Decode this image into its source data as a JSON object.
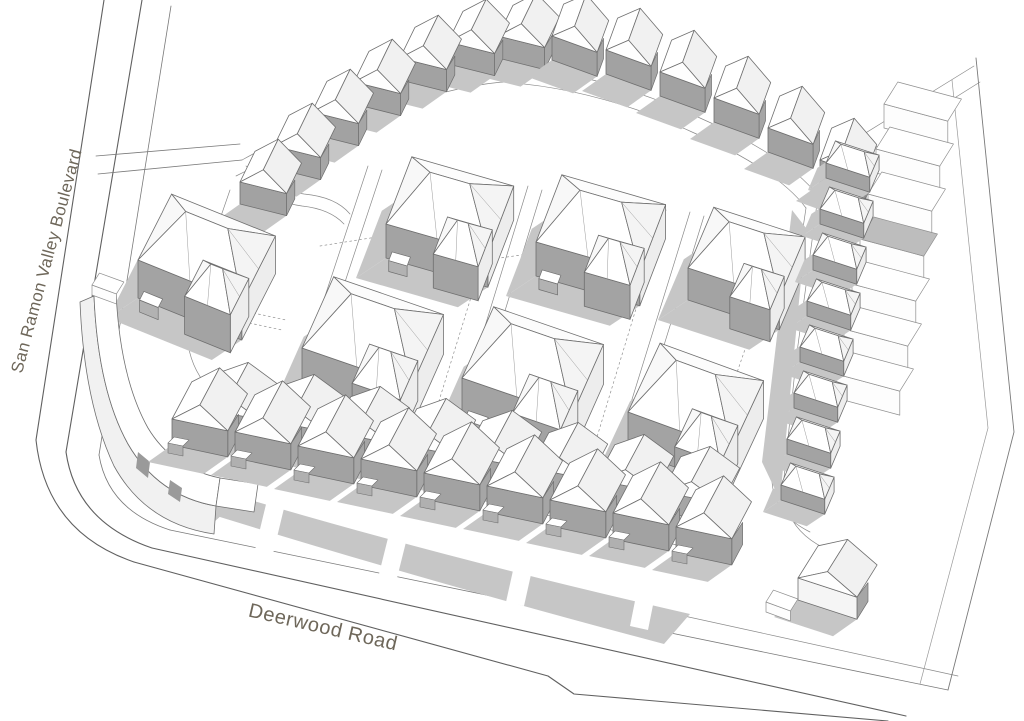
{
  "labels": {
    "boulevard": {
      "text": "San Ramon Valley Boulevard",
      "rotation_deg": -75
    },
    "road": {
      "text": "Deerwood Road",
      "rotation_deg": 13
    }
  },
  "diagram": {
    "kind": "3d-massing-site-plan-sketch",
    "ink": "#6f6f6f",
    "palette": {
      "background": "#ffffff",
      "wall_shade": "#a3a3a3",
      "wall_light": "#ededed",
      "roof_white": "#ffffff",
      "roof_tint": "#f2f2f2",
      "shadow": "#c6c6c6",
      "label_text": "#6e675a"
    },
    "ground": [
      {
        "d": "M 104,0 L 36,440",
        "s": "#606060",
        "w": 1.1
      },
      {
        "d": "M 142,0 L 66,452",
        "s": "#606060",
        "w": 1.1
      },
      {
        "d": "M 171,6 L 99,455",
        "s": "#7a7a7a",
        "w": 0.8
      },
      {
        "d": "M 36,440 Q 46,532 134,562",
        "s": "#606060",
        "w": 1.1
      },
      {
        "d": "M 66,452 Q 76,522 152,548",
        "s": "#606060",
        "w": 1.1
      },
      {
        "d": "M 99,455 Q 108,510 170,530",
        "s": "#7a7a7a",
        "w": 0.8
      },
      {
        "d": "M 134,562 L 548,676 L 574,694 L 888,721",
        "s": "#606060",
        "w": 1.1
      },
      {
        "d": "M 152,548 L 906,716",
        "s": "#606060",
        "w": 1.1
      },
      {
        "d": "M 170,530 L 948,690",
        "s": "#7a7a7a",
        "w": 0.8
      },
      {
        "d": "M 182,506 L 958,676",
        "s": "#8a8a8a",
        "w": 0.7
      },
      {
        "d": "M 948,690 L 1014,432 L 976,58",
        "s": "#7a7a7a",
        "w": 0.9
      },
      {
        "d": "M 920,684 L 988,428 L 952,80",
        "s": "#9a9a9a",
        "w": 0.7
      },
      {
        "d": "M 838,150 L 974,66",
        "s": "#8a8a8a",
        "w": 0.7
      },
      {
        "d": "M 846,166 L 980,82",
        "s": "#8a8a8a",
        "w": 0.7
      },
      {
        "d": "M 96,156 L 240,144",
        "s": "#7a7a7a",
        "w": 0.8
      },
      {
        "d": "M 98,174 L 242,160",
        "s": "#7a7a7a",
        "w": 0.8
      },
      {
        "d": "M 242,160 Q 300,128 360,104 Q 440,72 502,66 Q 600,72 700,118 Q 790,158 818,196",
        "s": "#8a8a8a",
        "w": 0.7
      },
      {
        "d": "M 236,176 Q 300,144 362,120 Q 440,88 502,82 Q 596,88 692,132 Q 778,170 806,208",
        "s": "#8a8a8a",
        "w": 0.7
      },
      {
        "d": "M 818,196 L 796,360 L 784,478 Q 780,526 824,548",
        "s": "#8a8a8a",
        "w": 0.7
      },
      {
        "d": "M 806,208 L 784,356 L 772,474 Q 770,512 810,532",
        "s": "#8a8a8a",
        "w": 0.7
      },
      {
        "d": "M 250,430 L 700,534",
        "s": "#8a8a8a",
        "w": 0.7
      },
      {
        "d": "M 246,446 L 690,548",
        "s": "#8a8a8a",
        "w": 0.7
      },
      {
        "d": "M 230,190 L 192,300 Q 176,356 214,394",
        "s": "#8a8a8a",
        "w": 0.7
      },
      {
        "d": "M 246,166 Q 274,190 304,194 Q 336,197 350,214",
        "s": "#8a8a8a",
        "w": 0.7
      },
      {
        "d": "M 242,178 Q 272,202 302,206 Q 330,209 344,224",
        "s": "#8a8a8a",
        "w": 0.7
      },
      {
        "d": "M 292,396 L 368,166",
        "s": "#8a8a8a",
        "w": 0.7
      },
      {
        "d": "M 306,400 L 382,170",
        "s": "#8a8a8a",
        "w": 0.7
      },
      {
        "d": "M 452,434 L 528,186",
        "s": "#8a8a8a",
        "w": 0.7
      },
      {
        "d": "M 466,438 L 542,190",
        "s": "#8a8a8a",
        "w": 0.7
      },
      {
        "d": "M 612,464 L 690,212",
        "s": "#8a8a8a",
        "w": 0.7
      },
      {
        "d": "M 626,468 L 704,216",
        "s": "#8a8a8a",
        "w": 0.7
      },
      {
        "d": "M 792,210 L 762,462 L 780,500 L 806,228 Z",
        "f": "#c6c6c6"
      },
      {
        "d": "M 836,252 L 918,240 L 912,266 L 830,278 Z",
        "f": "#c3c3c3"
      },
      {
        "d": "M 152,470 Q 400,548 690,614 L 664,644 Q 400,574 172,502 Z",
        "f": "#c6c6c6"
      },
      {
        "d": "M 268,496 L 286,500 L 272,558 L 254,554 Z",
        "f": "#ffffff"
      },
      {
        "d": "M 392,522 L 410,526 L 396,582 L 378,578 Z",
        "f": "#ffffff"
      },
      {
        "d": "M 518,548 L 536,552 L 524,606 L 506,602 Z",
        "f": "#ffffff"
      },
      {
        "d": "M 640,576 L 658,580 L 648,630 L 630,626 Z",
        "f": "#ffffff"
      },
      {
        "d": "M 142,300 L 282,330",
        "s": "#909090",
        "w": 0.7,
        "dash": "2 3"
      },
      {
        "d": "M 146,290 L 286,320",
        "s": "#909090",
        "w": 0.7,
        "dash": "2 3"
      },
      {
        "d": "M 430,430 L 506,184",
        "s": "#909090",
        "w": 0.7,
        "dash": "2 3"
      },
      {
        "d": "M 590,460 L 666,210",
        "s": "#909090",
        "w": 0.7,
        "dash": "2 3"
      },
      {
        "d": "M 700,480 L 762,300",
        "s": "#909090",
        "w": 0.7,
        "dash": "2 3"
      },
      {
        "d": "M 320,246 L 446,226",
        "s": "#909090",
        "w": 0.7,
        "dash": "2 3"
      },
      {
        "d": "M 472,262 L 598,244",
        "s": "#909090",
        "w": 0.7,
        "dash": "2 3"
      }
    ],
    "buildings": [
      {
        "group": "neighboring-buildings-east",
        "type": "slab",
        "dir_deg": 15,
        "w": 66,
        "d": 26,
        "h": 24,
        "p_list": [
          [
            884,
            128
          ],
          [
            876,
            173
          ],
          [
            868,
            218
          ],
          [
            860,
            263
          ],
          [
            852,
            308
          ],
          [
            844,
            353
          ],
          [
            836,
            398
          ]
        ],
        "roof_fills": [
          "#ffffff",
          "#ffffff",
          "#ffffff",
          "#bdbdbd",
          "#ffffff",
          "#ffffff",
          "#ffffff"
        ]
      },
      {
        "group": "townhouse-row-north-west",
        "type": "gable-row",
        "base_dir_deg": 14,
        "roof_dir_deg": -64,
        "unit_w": 48,
        "wall_h": 22,
        "roof_h": 18,
        "roof_depth": 34,
        "front_fill": "#a2a2a2",
        "porch": false,
        "anchors": [
          [
            498,
            58
          ],
          [
            448,
            64
          ],
          [
            400,
            80
          ],
          [
            354,
            104
          ],
          [
            312,
            134
          ],
          [
            274,
            168
          ],
          [
            240,
            204
          ]
        ]
      },
      {
        "group": "townhouse-row-north-east",
        "type": "gable-row",
        "base_dir_deg": 20,
        "roof_dir_deg": -70,
        "unit_w": 48,
        "wall_h": 24,
        "roof_h": 18,
        "roof_depth": 34,
        "front_fill": "#a2a2a2",
        "porch": false,
        "anchors": [
          [
            552,
            60
          ],
          [
            606,
            74
          ],
          [
            660,
            96
          ],
          [
            714,
            122
          ],
          [
            768,
            152
          ],
          [
            820,
            184
          ]
        ]
      },
      {
        "group": "detached-house",
        "type": "hip",
        "dir_deg": 16,
        "w": 106,
        "d": 72,
        "wall_h": 34,
        "roof_h": 27,
        "wing": true,
        "porch": true,
        "p_list": [
          [
            386,
            258
          ]
        ]
      },
      {
        "group": "detached-house",
        "type": "hip",
        "dir_deg": 16,
        "w": 108,
        "d": 72,
        "wall_h": 34,
        "roof_h": 27,
        "wing": true,
        "porch": true,
        "p_list": [
          [
            536,
            276
          ]
        ]
      },
      {
        "group": "detached-house",
        "type": "hip",
        "dir_deg": 22,
        "w": 112,
        "d": 74,
        "wall_h": 38,
        "roof_h": 28,
        "wing": true,
        "porch": true,
        "p_list": [
          [
            138,
            298
          ]
        ]
      },
      {
        "group": "detached-house",
        "type": "hip",
        "dir_deg": 18,
        "w": 96,
        "d": 66,
        "wall_h": 32,
        "roof_h": 25,
        "wing": true,
        "porch": false,
        "p_list": [
          [
            688,
            300
          ]
        ]
      },
      {
        "group": "townhouse-row-east",
        "type": "hip",
        "dir_deg": 18,
        "w": 46,
        "d": 24,
        "wall_h": 15,
        "roof_h": 11,
        "wing": false,
        "porch": false,
        "p_list": [
          [
            826,
            178
          ],
          [
            820,
            224
          ],
          [
            813,
            270
          ],
          [
            807,
            316
          ],
          [
            800,
            362
          ],
          [
            794,
            408
          ],
          [
            787,
            454
          ],
          [
            781,
            500
          ]
        ]
      },
      {
        "group": "detached-house",
        "type": "hip",
        "dir_deg": 19,
        "w": 116,
        "d": 78,
        "wall_h": 40,
        "roof_h": 30,
        "wing": true,
        "porch": true,
        "p_list": [
          [
            302,
            388
          ]
        ]
      },
      {
        "group": "detached-house",
        "type": "hip",
        "dir_deg": 19,
        "w": 116,
        "d": 78,
        "wall_h": 40,
        "roof_h": 30,
        "wing": true,
        "porch": true,
        "p_list": [
          [
            462,
            418
          ]
        ]
      },
      {
        "group": "detached-house",
        "type": "hip",
        "dir_deg": 20,
        "w": 110,
        "d": 76,
        "wall_h": 38,
        "roof_h": 29,
        "wing": true,
        "porch": true,
        "p_list": [
          [
            628,
            450
          ]
        ]
      },
      {
        "group": "corner-building",
        "type": "paths",
        "paths": [
          {
            "d": "M 118,392 Q 146,458 204,492 L 232,506 L 214,522 Q 148,498 116,452 Q 98,420 96,382 Z",
            "f": "#c6c6c6"
          },
          {
            "d": "M 94,296 Q 98,390 128,444 Q 158,496 216,506 L 214,534 Q 146,524 114,466 Q 84,402 80,302 Z",
            "f": "#f1f1f1",
            "s": "#6f6f6f",
            "w": 0.8
          },
          {
            "d": "M 94,296 L 116,292 Q 120,378 148,428 Q 172,468 220,478 L 216,506 Q 158,496 128,444 Q 98,390 94,296 Z",
            "f": "#ffffff",
            "s": "#6f6f6f",
            "w": 0.8
          },
          {
            "d": "M 138,452 L 150,462 L 148,478 L 136,468 Z",
            "f": "#9a9a9a"
          },
          {
            "d": "M 170,480 L 182,488 L 180,502 L 168,494 Z",
            "f": "#9a9a9a"
          },
          {
            "d": "M 220,478 L 258,484 L 254,512 L 216,506 Z",
            "f": "#ffffff",
            "s": "#6f6f6f",
            "w": 0.8
          }
        ]
      },
      {
        "group": "townhouse-row-south-back",
        "type": "gable-row",
        "base_dir_deg": 11,
        "roof_dir_deg": -62,
        "unit_w": 60,
        "wall_h": 20,
        "roof_h": 16,
        "roof_depth": 40,
        "front_fill": "#a6a6a6",
        "porch": false,
        "anchors": [
          [
            200,
            428
          ],
          [
            266,
            440
          ],
          [
            332,
            452
          ],
          [
            398,
            464
          ],
          [
            464,
            476
          ],
          [
            530,
            488
          ],
          [
            596,
            500
          ],
          [
            662,
            512
          ]
        ]
      },
      {
        "group": "townhouse-row-south-front",
        "type": "gable-row",
        "base_dir_deg": 12,
        "roof_dir_deg": -62,
        "unit_w": 57,
        "wall_h": 26,
        "roof_h": 20,
        "roof_depth": 42,
        "front_fill": "#a2a2a2",
        "porch": true,
        "anchors": [
          [
            172,
            445
          ],
          [
            235,
            458
          ],
          [
            298,
            472
          ],
          [
            361,
            485
          ],
          [
            424,
            499
          ],
          [
            487,
            512
          ],
          [
            550,
            526
          ],
          [
            613,
            539
          ],
          [
            676,
            553
          ]
        ]
      },
      {
        "group": "corner-lot-building",
        "type": "gable-row",
        "base_dir_deg": 18,
        "roof_dir_deg": -58,
        "unit_w": 62,
        "wall_h": 22,
        "roof_h": 16,
        "roof_depth": 38,
        "front_fill": "#f5f5f5",
        "porch": false,
        "anchors": [
          [
            798,
            600
          ]
        ]
      },
      {
        "group": "misc-structure",
        "type": "slab",
        "dir_deg": 20,
        "w": 26,
        "d": 14,
        "h": 10,
        "p_list": [
          [
            92,
            295
          ],
          [
            766,
            612
          ]
        ],
        "roof_fills": [
          "#ffffff",
          "#ffffff"
        ]
      }
    ]
  }
}
